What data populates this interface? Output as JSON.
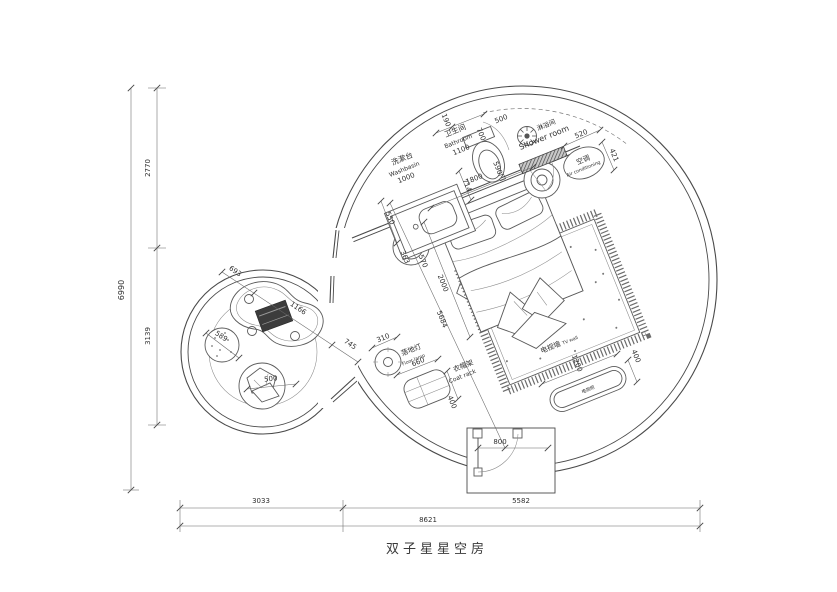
{
  "title": "双子星星空房",
  "left_dims": {
    "total": "6990",
    "top": "2770",
    "bottom": "3139"
  },
  "bottom_dims": {
    "left": "3033",
    "right": "5582",
    "total": "8621"
  },
  "rooms": {
    "washbasin": {
      "zh": "洗漱台",
      "en": "Washbasin",
      "size": "1000",
      "depth": "550"
    },
    "bathroom": {
      "zh": "卫生间",
      "en": "Bathroom",
      "size": "1100",
      "toilet_width": "714",
      "door": "590门",
      "d190": "190",
      "d700": "700",
      "d500": "500"
    },
    "shower": {
      "zh": "淋浴间",
      "en": "Shower room"
    },
    "ac": {
      "zh": "空调",
      "en": "Air conditioning",
      "d520": "520",
      "d421": "421"
    },
    "bed": {
      "width": "1800",
      "length": "2000",
      "diagonal": "5684",
      "nightstand_a": "363",
      "nightstand_b": "570"
    },
    "floor_lamp": {
      "zh": "落地灯",
      "en": "Floor lamp",
      "size": "310"
    },
    "coat_rack": {
      "zh": "衣帽架",
      "en": "Coat rack",
      "w": "660",
      "d": "400"
    },
    "tv": {
      "wall_zh": "电视墙",
      "wall_en": "TV wall",
      "w": "1200",
      "d": "400",
      "cabinet": "电视柜"
    },
    "entry": {
      "door": "800"
    },
    "lounge": {
      "d693": "693",
      "d1166": "1166",
      "d745": "745",
      "d589": "589",
      "d500": "500"
    }
  }
}
